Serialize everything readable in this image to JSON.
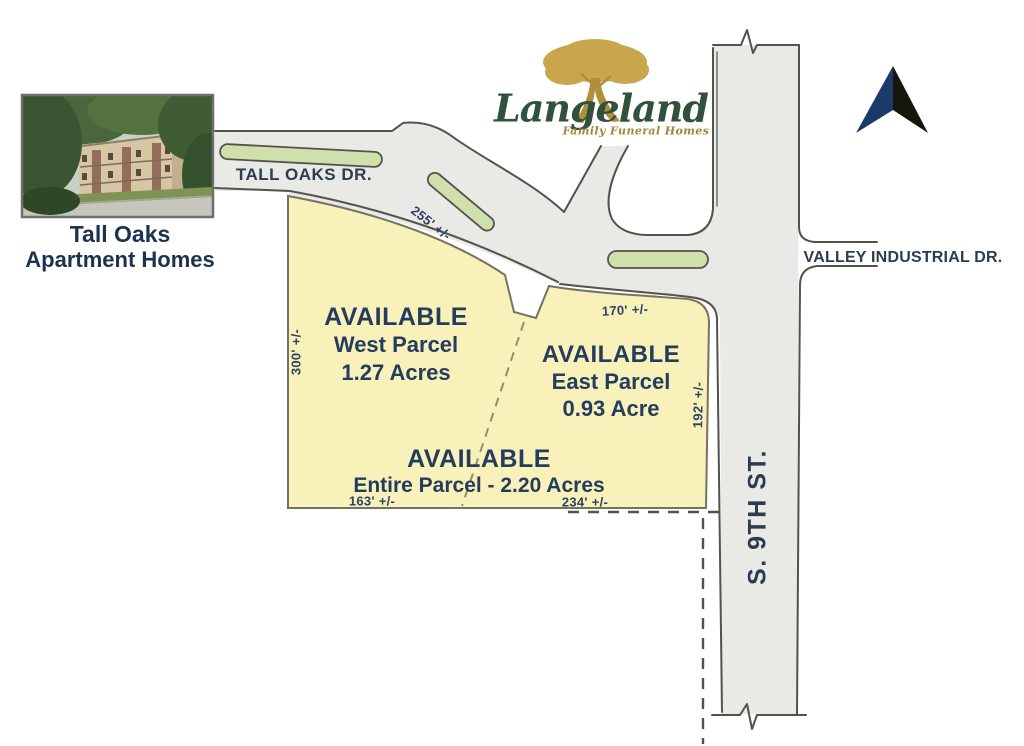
{
  "landmark_photo": {
    "caption_line1": "Tall Oaks",
    "caption_line2": "Apartment Homes"
  },
  "logo": {
    "name": "Langeland",
    "tagline": "Family Funeral Homes"
  },
  "roads": {
    "tall_oaks": "TALL OAKS DR.",
    "valley_industrial": "VALLEY INDUSTRIAL DR.",
    "s_9th": "S. 9TH ST."
  },
  "parcels": {
    "west": {
      "status": "AVAILABLE",
      "name": "West Parcel",
      "area": "1.27 Acres"
    },
    "east": {
      "status": "AVAILABLE",
      "name": "East Parcel",
      "area": "0.93 Acre"
    },
    "entire": {
      "status": "AVAILABLE",
      "name_area": "Entire Parcel - 2.20 Acres"
    }
  },
  "dimensions": {
    "north_curve": "255' +/-",
    "west_side": "300' +/-",
    "east_parcel_top": "170' +/-",
    "east_side": "192' +/-",
    "bottom_west": "163' +/-",
    "bottom_east": "234' +/-"
  },
  "icons": {
    "north_arrow_icon": "chevron-up-north-pointer",
    "langeland_tree_icon": "gold-oak-tree"
  },
  "colors": {
    "parcel_fill": "#f8f1ba",
    "road_fill": "#e9e9e5",
    "median_fill": "#cfe0ad",
    "curb": "#54524d",
    "label_navy": "#243c5e",
    "road_label": "#2b3c50",
    "logo_green": "#30523d",
    "logo_gold": "#c9a54b",
    "arrow_navy": "#1c3a67",
    "arrow_dark": "#16160f"
  }
}
